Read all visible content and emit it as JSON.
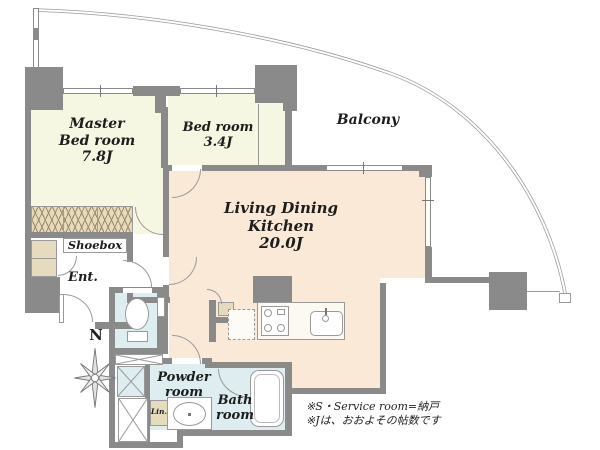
{
  "plan": {
    "rooms": {
      "master_bedroom": {
        "lines": [
          "Master",
          "Bed room",
          "7.8J"
        ]
      },
      "bedroom": {
        "lines": [
          "Bed room",
          "3.4J"
        ]
      },
      "ldk": {
        "lines": [
          "Living Dining",
          "Kitchen",
          "20.0J"
        ]
      },
      "balcony": {
        "label": "Balcony"
      },
      "shoebox": {
        "label": "Shoebox"
      },
      "entrance": {
        "label": "Ent."
      },
      "powder_room": {
        "lines": [
          "Powder",
          "room"
        ]
      },
      "bath_room": {
        "lines": [
          "Bath",
          "room"
        ]
      },
      "linen": {
        "label": "Lin."
      }
    },
    "compass": {
      "north_label": "N"
    },
    "notes": {
      "line1": "※S・Service room=納戸",
      "line2": "※Jは、おおよその帖数です"
    },
    "colors": {
      "wall": "#8a8a8a",
      "bedroom_floor": "#f6f7e3",
      "ldk_floor": "#fbe9d8",
      "wet_area_floor": "#ddedf0",
      "closet": "#e7dbbd",
      "line": "#999999",
      "text": "#1d1d1d"
    }
  }
}
